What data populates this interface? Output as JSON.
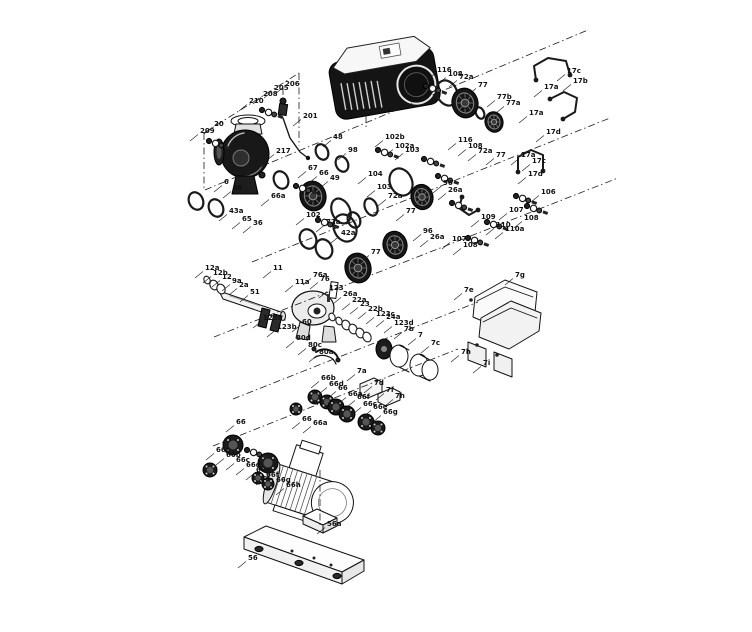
{
  "figure": {
    "type": "exploded-parts-diagram",
    "ink": "#1a1a1a",
    "label_color": "#111111",
    "background": "#ffffff",
    "labels": [
      {
        "t": "209",
        "x": 200,
        "y": 133
      },
      {
        "t": "20",
        "x": 214,
        "y": 126
      },
      {
        "t": "210",
        "x": 249,
        "y": 103
      },
      {
        "t": "208",
        "x": 263,
        "y": 96
      },
      {
        "t": "205",
        "x": 274,
        "y": 90
      },
      {
        "t": "206",
        "x": 285,
        "y": 86
      },
      {
        "t": "201",
        "x": 303,
        "y": 118
      },
      {
        "t": "217",
        "x": 276,
        "y": 153
      },
      {
        "t": "6",
        "x": 224,
        "y": 184
      },
      {
        "t": "98",
        "x": 233,
        "y": 190
      },
      {
        "t": "43a",
        "x": 229,
        "y": 213
      },
      {
        "t": "65",
        "x": 242,
        "y": 221
      },
      {
        "t": "36",
        "x": 253,
        "y": 225
      },
      {
        "t": "48",
        "x": 333,
        "y": 139
      },
      {
        "t": "98",
        "x": 348,
        "y": 152
      },
      {
        "t": "67",
        "x": 308,
        "y": 170
      },
      {
        "t": "66",
        "x": 319,
        "y": 175
      },
      {
        "t": "49",
        "x": 330,
        "y": 180
      },
      {
        "t": "66a",
        "x": 271,
        "y": 198
      },
      {
        "t": "102",
        "x": 306,
        "y": 217
      },
      {
        "t": "72a",
        "x": 326,
        "y": 224
      },
      {
        "t": "116",
        "x": 437,
        "y": 72
      },
      {
        "t": "108",
        "x": 448,
        "y": 76
      },
      {
        "t": "72a",
        "x": 459,
        "y": 79
      },
      {
        "t": "77",
        "x": 478,
        "y": 87
      },
      {
        "t": "77b",
        "x": 497,
        "y": 99
      },
      {
        "t": "77a",
        "x": 506,
        "y": 105
      },
      {
        "t": "17c",
        "x": 567,
        "y": 73
      },
      {
        "t": "17b",
        "x": 573,
        "y": 83
      },
      {
        "t": "17a",
        "x": 544,
        "y": 89
      },
      {
        "t": "17a",
        "x": 529,
        "y": 115
      },
      {
        "t": "17d",
        "x": 546,
        "y": 134
      },
      {
        "t": "102b",
        "x": 385,
        "y": 139
      },
      {
        "t": "102a",
        "x": 395,
        "y": 148
      },
      {
        "t": "103",
        "x": 405,
        "y": 152
      },
      {
        "t": "116",
        "x": 458,
        "y": 142
      },
      {
        "t": "108",
        "x": 468,
        "y": 148
      },
      {
        "t": "72a",
        "x": 478,
        "y": 153
      },
      {
        "t": "77",
        "x": 496,
        "y": 157
      },
      {
        "t": "96",
        "x": 443,
        "y": 185
      },
      {
        "t": "26a",
        "x": 448,
        "y": 192
      },
      {
        "t": "17a",
        "x": 521,
        "y": 157
      },
      {
        "t": "17c",
        "x": 532,
        "y": 163
      },
      {
        "t": "17d",
        "x": 528,
        "y": 176
      },
      {
        "t": "106",
        "x": 541,
        "y": 194
      },
      {
        "t": "107",
        "x": 509,
        "y": 212
      },
      {
        "t": "108",
        "x": 524,
        "y": 220
      },
      {
        "t": "109",
        "x": 481,
        "y": 219
      },
      {
        "t": "110",
        "x": 496,
        "y": 227
      },
      {
        "t": "110a",
        "x": 505,
        "y": 231
      },
      {
        "t": "107",
        "x": 452,
        "y": 241
      },
      {
        "t": "108",
        "x": 463,
        "y": 247
      },
      {
        "t": "104",
        "x": 368,
        "y": 176
      },
      {
        "t": "103",
        "x": 377,
        "y": 189
      },
      {
        "t": "72a",
        "x": 388,
        "y": 198
      },
      {
        "t": "77",
        "x": 406,
        "y": 213
      },
      {
        "t": "42a",
        "x": 341,
        "y": 235
      },
      {
        "t": "96",
        "x": 423,
        "y": 233
      },
      {
        "t": "26a",
        "x": 430,
        "y": 239
      },
      {
        "t": "77",
        "x": 371,
        "y": 254
      },
      {
        "t": "12a",
        "x": 205,
        "y": 270
      },
      {
        "t": "12b",
        "x": 213,
        "y": 275
      },
      {
        "t": "12",
        "x": 222,
        "y": 279
      },
      {
        "t": "9a",
        "x": 232,
        "y": 283
      },
      {
        "t": "2a",
        "x": 239,
        "y": 287
      },
      {
        "t": "11",
        "x": 273,
        "y": 270
      },
      {
        "t": "51",
        "x": 250,
        "y": 294
      },
      {
        "t": "11a",
        "x": 295,
        "y": 284
      },
      {
        "t": "76a",
        "x": 313,
        "y": 277
      },
      {
        "t": "76",
        "x": 320,
        "y": 281
      },
      {
        "t": "123",
        "x": 329,
        "y": 290
      },
      {
        "t": "123a",
        "x": 263,
        "y": 320
      },
      {
        "t": "123b",
        "x": 277,
        "y": 329
      },
      {
        "t": "60",
        "x": 302,
        "y": 324
      },
      {
        "t": "26a",
        "x": 343,
        "y": 296
      },
      {
        "t": "22a",
        "x": 352,
        "y": 302
      },
      {
        "t": "23",
        "x": 360,
        "y": 306
      },
      {
        "t": "22b",
        "x": 368,
        "y": 311
      },
      {
        "t": "123c",
        "x": 376,
        "y": 316
      },
      {
        "t": "24a",
        "x": 386,
        "y": 319
      },
      {
        "t": "123d",
        "x": 394,
        "y": 325
      },
      {
        "t": "7b",
        "x": 404,
        "y": 331
      },
      {
        "t": "7",
        "x": 418,
        "y": 337
      },
      {
        "t": "7c",
        "x": 431,
        "y": 345
      },
      {
        "t": "80d",
        "x": 296,
        "y": 340
      },
      {
        "t": "80c",
        "x": 308,
        "y": 347
      },
      {
        "t": "80a",
        "x": 319,
        "y": 354
      },
      {
        "t": "7a",
        "x": 357,
        "y": 373
      },
      {
        "t": "7d",
        "x": 374,
        "y": 385
      },
      {
        "t": "7f",
        "x": 386,
        "y": 392
      },
      {
        "t": "7h",
        "x": 395,
        "y": 398
      },
      {
        "t": "7g",
        "x": 515,
        "y": 277
      },
      {
        "t": "7e",
        "x": 464,
        "y": 292
      },
      {
        "t": "7h",
        "x": 461,
        "y": 354
      },
      {
        "t": "7i",
        "x": 483,
        "y": 365
      },
      {
        "t": "66b",
        "x": 321,
        "y": 380
      },
      {
        "t": "66d",
        "x": 329,
        "y": 386
      },
      {
        "t": "66",
        "x": 338,
        "y": 390
      },
      {
        "t": "66a",
        "x": 348,
        "y": 396
      },
      {
        "t": "66f",
        "x": 357,
        "y": 399
      },
      {
        "t": "66c",
        "x": 363,
        "y": 406
      },
      {
        "t": "66e",
        "x": 373,
        "y": 409
      },
      {
        "t": "66g",
        "x": 383,
        "y": 414
      },
      {
        "t": "66",
        "x": 302,
        "y": 421
      },
      {
        "t": "66a",
        "x": 313,
        "y": 425
      },
      {
        "t": "66",
        "x": 236,
        "y": 424
      },
      {
        "t": "66a",
        "x": 216,
        "y": 452
      },
      {
        "t": "66b",
        "x": 226,
        "y": 457
      },
      {
        "t": "66c",
        "x": 236,
        "y": 462
      },
      {
        "t": "66d",
        "x": 246,
        "y": 467
      },
      {
        "t": "66e",
        "x": 256,
        "y": 472
      },
      {
        "t": "66f",
        "x": 266,
        "y": 477
      },
      {
        "t": "66g",
        "x": 276,
        "y": 482
      },
      {
        "t": "66h",
        "x": 286,
        "y": 487
      },
      {
        "t": "56",
        "x": 248,
        "y": 560
      },
      {
        "t": "56a",
        "x": 327,
        "y": 526
      }
    ],
    "dash_lines": [
      [
        204,
        133,
        299,
        73
      ],
      [
        204,
        133,
        204,
        190
      ],
      [
        299,
        73,
        299,
        146
      ],
      [
        205,
        190,
        588,
        30
      ],
      [
        252,
        262,
        610,
        118
      ],
      [
        214,
        337,
        618,
        178
      ],
      [
        233,
        399,
        478,
        302
      ],
      [
        213,
        446,
        458,
        349
      ],
      [
        366,
        101,
        366,
        130
      ],
      [
        320,
        470,
        320,
        527
      ],
      [
        283,
        88,
        283,
        104
      ]
    ],
    "orings": [
      [
        196,
        201,
        7,
        9
      ],
      [
        216,
        208,
        7,
        9
      ],
      [
        281,
        180,
        7,
        9
      ],
      [
        322,
        152,
        6,
        8
      ],
      [
        342,
        164,
        6,
        8
      ],
      [
        345,
        228,
        11,
        14
      ],
      [
        308,
        239,
        8,
        10
      ],
      [
        324,
        249,
        8,
        10
      ],
      [
        341,
        211,
        9,
        13
      ],
      [
        371,
        207,
        6,
        9
      ],
      [
        354,
        220,
        6,
        8
      ],
      [
        447,
        93,
        10,
        13
      ],
      [
        401,
        182,
        11,
        14
      ],
      [
        480,
        113,
        4,
        6
      ]
    ],
    "rings": [
      [
        332,
        317,
        3,
        4
      ],
      [
        339,
        321,
        3,
        4
      ],
      [
        346,
        325,
        4,
        5
      ],
      [
        353,
        329,
        4,
        5
      ],
      [
        360,
        333,
        4,
        5
      ],
      [
        367,
        337,
        4,
        5
      ],
      [
        207,
        280,
        3,
        4
      ],
      [
        214,
        285,
        4,
        5
      ],
      [
        221,
        289,
        4,
        5
      ]
    ],
    "rotors": [
      [
        465,
        103,
        13
      ],
      [
        494,
        122,
        9
      ],
      [
        422,
        197,
        11
      ],
      [
        395,
        245,
        12
      ],
      [
        358,
        268,
        13
      ]
    ],
    "impeller": [
      313,
      196,
      13
    ],
    "discs": [
      [
        233,
        445,
        10
      ],
      [
        268,
        463,
        10
      ],
      [
        210,
        470,
        7
      ],
      [
        296,
        409,
        6
      ],
      [
        315,
        397,
        7
      ],
      [
        327,
        402,
        7
      ],
      [
        336,
        407,
        8
      ],
      [
        347,
        414,
        8
      ],
      [
        366,
        422,
        8
      ],
      [
        378,
        428,
        7
      ],
      [
        258,
        478,
        6
      ],
      [
        268,
        484,
        6
      ]
    ],
    "fasteners": [
      [
        378,
        150
      ],
      [
        424,
        159
      ],
      [
        426,
        86
      ],
      [
        452,
        203
      ],
      [
        487,
        222
      ],
      [
        516,
        196
      ],
      [
        527,
        206
      ],
      [
        468,
        238
      ],
      [
        438,
        176
      ],
      [
        318,
        220
      ],
      [
        296,
        186
      ],
      [
        209,
        141
      ],
      [
        262,
        110
      ],
      [
        247,
        450
      ]
    ],
    "pipes": [
      [
        536,
        80,
        534,
        66,
        548,
        58,
        566,
        61,
        570,
        75
      ],
      [
        550,
        99,
        564,
        92,
        577,
        98,
        575,
        112,
        563,
        119
      ],
      [
        518,
        172,
        518,
        157,
        531,
        150,
        543,
        155,
        543,
        171
      ],
      [
        462,
        197,
        459,
        208,
        469,
        215,
        478,
        210
      ]
    ]
  }
}
